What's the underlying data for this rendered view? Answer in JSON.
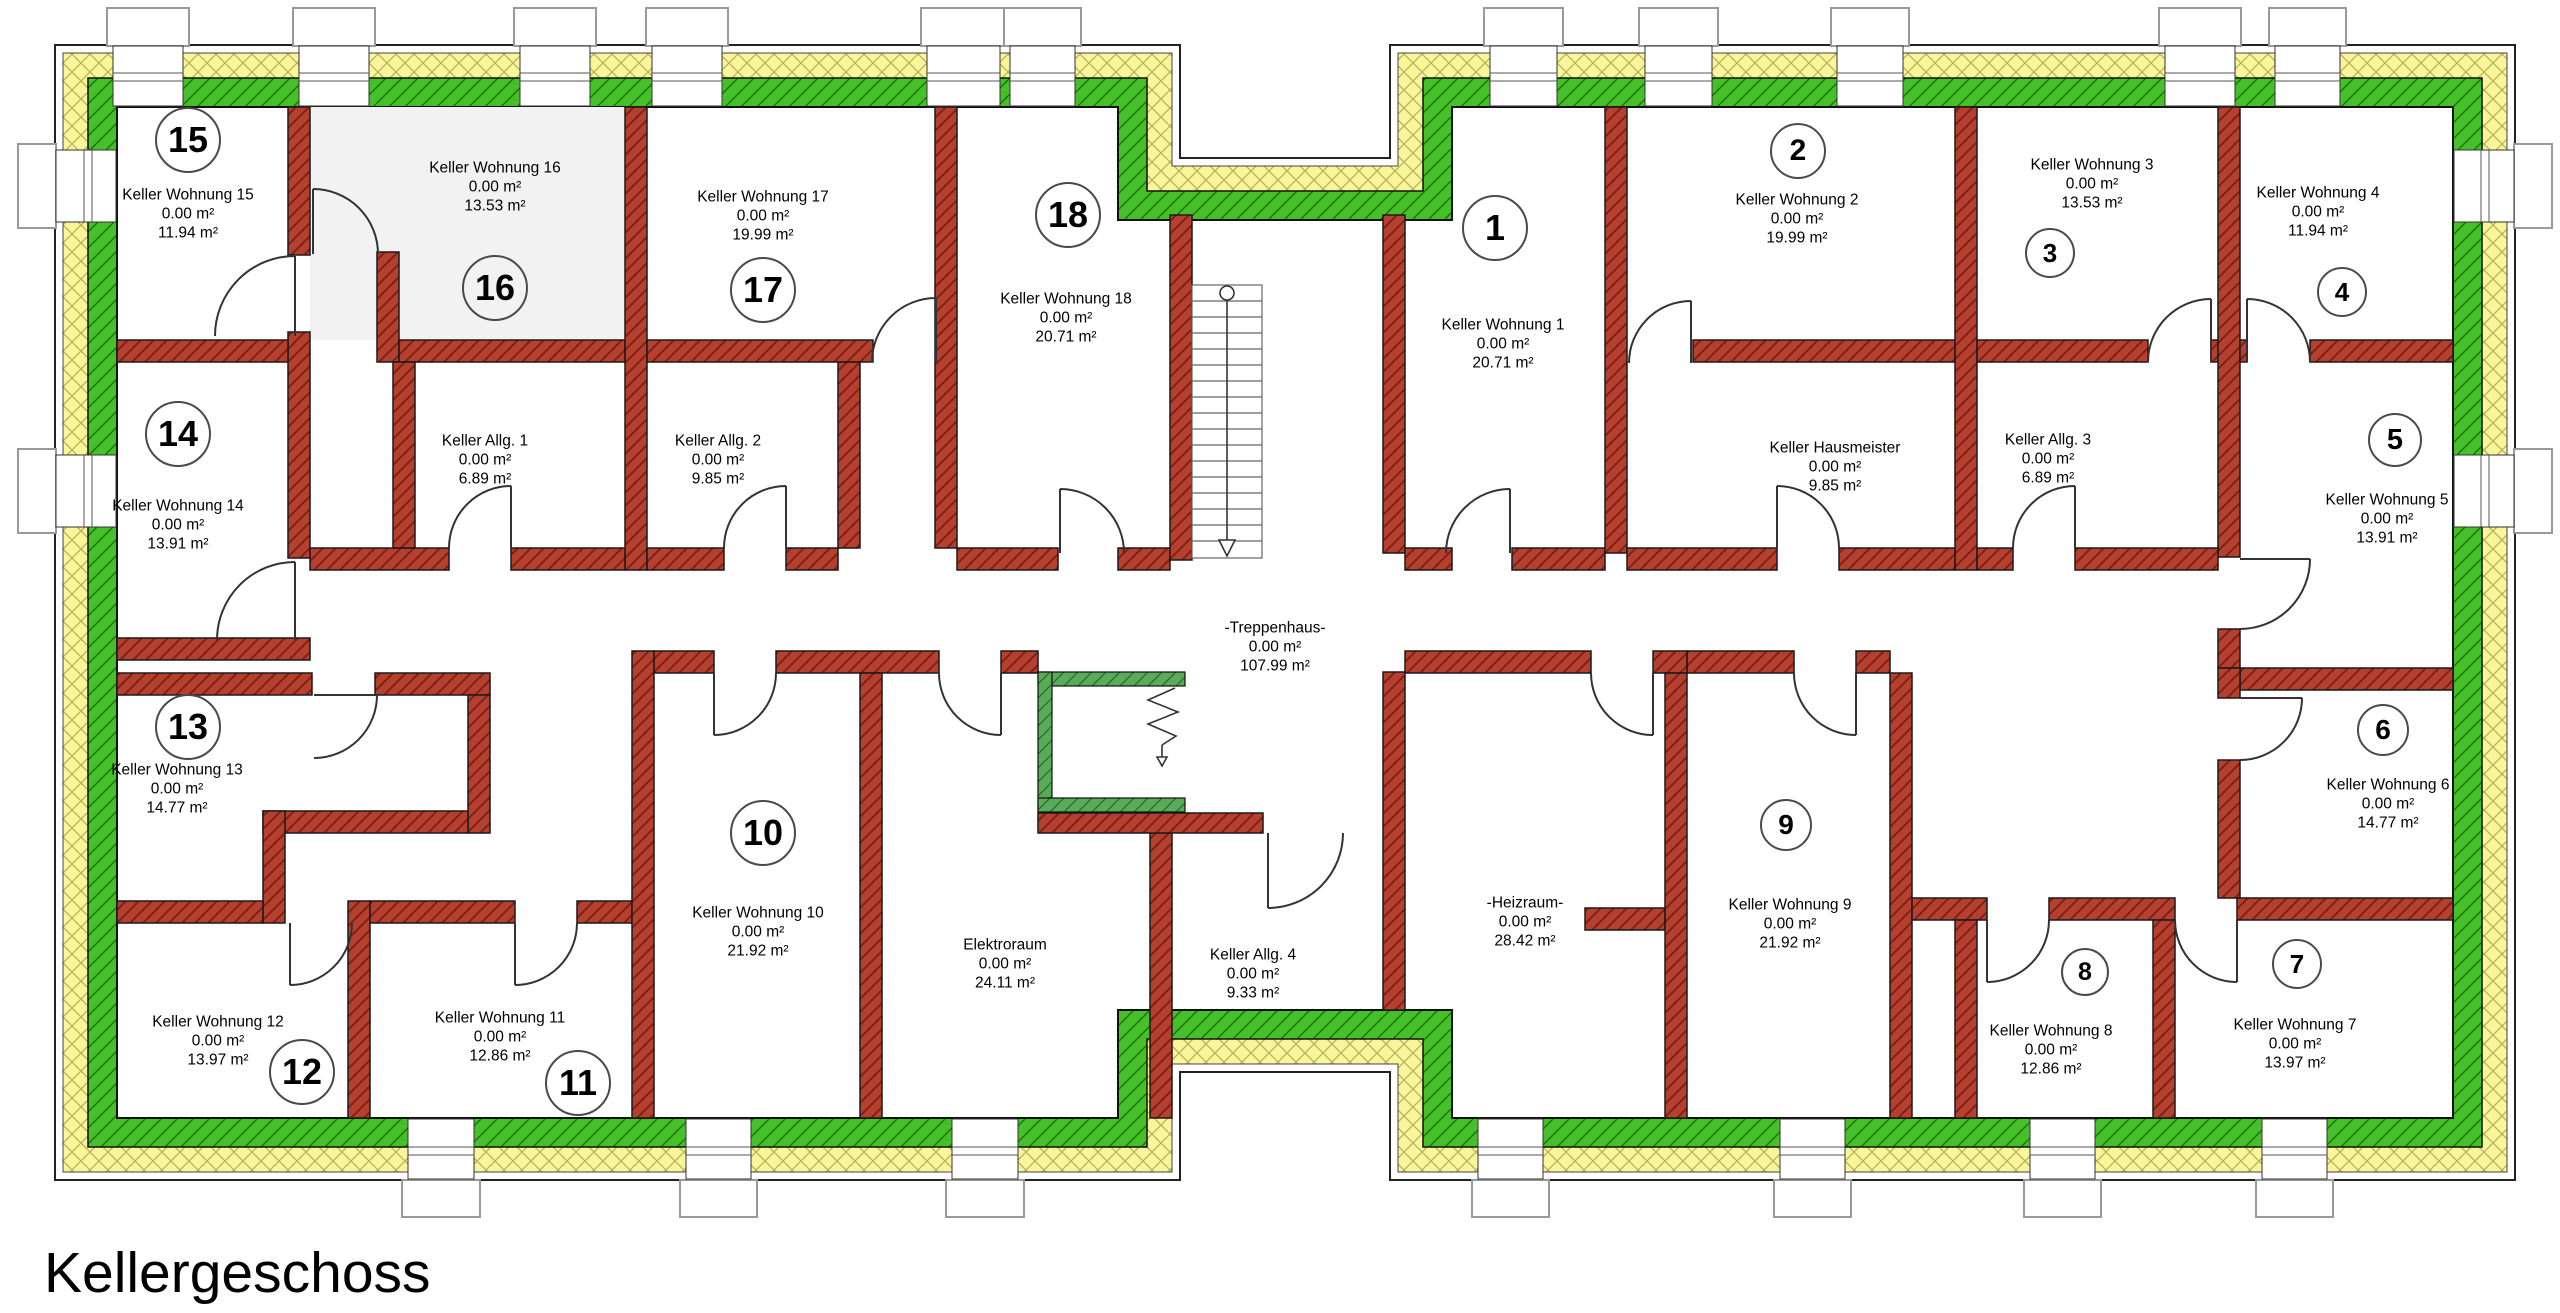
{
  "title": "Kellergeschoss",
  "colors": {
    "exterior_outer_hatch": "#f8f59b",
    "exterior_inner_hatch": "#46c028",
    "interior_wall_hatch": "#b6402f",
    "elevator_hatch": "#58ab57",
    "highlight_room_fill": "#f2f2f2"
  },
  "rooms": [
    {
      "num": "1",
      "name": "Keller Wohnung 1",
      "size": "0.00 m²",
      "area": "20.71 m²",
      "label": {
        "x": 1503,
        "y": 344
      },
      "badge": {
        "x": 1495,
        "y": 228,
        "r": 31
      }
    },
    {
      "num": "2",
      "name": "Keller Wohnung 2",
      "size": "0.00 m²",
      "area": "19.99 m²",
      "label": {
        "x": 1797,
        "y": 219
      },
      "badge": {
        "x": 1798,
        "y": 151,
        "r": 26
      }
    },
    {
      "num": "3",
      "name": "Keller Wohnung 3",
      "size": "0.00 m²",
      "area": "13.53 m²",
      "label": {
        "x": 2092,
        "y": 184
      },
      "badge": {
        "x": 2050,
        "y": 253,
        "r": 23
      }
    },
    {
      "num": "4",
      "name": "Keller Wohnung 4",
      "size": "0.00 m²",
      "area": "11.94 m²",
      "label": {
        "x": 2318,
        "y": 212
      },
      "badge": {
        "x": 2342,
        "y": 292,
        "r": 23
      }
    },
    {
      "num": "5",
      "name": "Keller Wohnung 5",
      "size": "0.00 m²",
      "area": "13.91 m²",
      "label": {
        "x": 2387,
        "y": 519
      },
      "badge": {
        "x": 2395,
        "y": 440,
        "r": 25
      }
    },
    {
      "num": "6",
      "name": "Keller Wohnung 6",
      "size": "0.00 m²",
      "area": "14.77 m²",
      "label": {
        "x": 2388,
        "y": 804
      },
      "badge": {
        "x": 2383,
        "y": 730,
        "r": 24
      }
    },
    {
      "num": "7",
      "name": "Keller Wohnung 7",
      "size": "0.00 m²",
      "area": "13.97 m²",
      "label": {
        "x": 2295,
        "y": 1044
      },
      "badge": {
        "x": 2297,
        "y": 964,
        "r": 23
      }
    },
    {
      "num": "8",
      "name": "Keller Wohnung 8",
      "size": "0.00 m²",
      "area": "12.86 m²",
      "label": {
        "x": 2051,
        "y": 1050
      },
      "badge": {
        "x": 2085,
        "y": 972,
        "r": 22
      }
    },
    {
      "num": "9",
      "name": "Keller Wohnung 9",
      "size": "0.00 m²",
      "area": "21.92 m²",
      "label": {
        "x": 1790,
        "y": 924
      },
      "badge": {
        "x": 1786,
        "y": 825,
        "r": 24
      }
    },
    {
      "num": "10",
      "name": "Keller Wohnung 10",
      "size": "0.00 m²",
      "area": "21.92 m²",
      "label": {
        "x": 758,
        "y": 932
      },
      "badge": {
        "x": 763,
        "y": 833,
        "r": 31
      }
    },
    {
      "num": "11",
      "name": "Keller Wohnung 11",
      "size": "0.00 m²",
      "area": "12.86 m²",
      "label": {
        "x": 500,
        "y": 1037
      },
      "badge": {
        "x": 578,
        "y": 1083,
        "r": 31
      }
    },
    {
      "num": "12",
      "name": "Keller Wohnung 12",
      "size": "0.00 m²",
      "area": "13.97 m²",
      "label": {
        "x": 218,
        "y": 1041
      },
      "badge": {
        "x": 302,
        "y": 1072,
        "r": 31
      }
    },
    {
      "num": "13",
      "name": "Keller Wohnung 13",
      "size": "0.00 m²",
      "area": "14.77 m²",
      "label": {
        "x": 177,
        "y": 789
      },
      "badge": {
        "x": 188,
        "y": 727,
        "r": 31
      }
    },
    {
      "num": "14",
      "name": "Keller Wohnung 14",
      "size": "0.00 m²",
      "area": "13.91 m²",
      "label": {
        "x": 178,
        "y": 525
      },
      "badge": {
        "x": 178,
        "y": 434,
        "r": 31
      }
    },
    {
      "num": "15",
      "name": "Keller Wohnung 15",
      "size": "0.00 m²",
      "area": "11.94 m²",
      "label": {
        "x": 188,
        "y": 214
      },
      "badge": {
        "x": 188,
        "y": 140,
        "r": 31
      }
    },
    {
      "num": "16",
      "name": "Keller Wohnung 16",
      "size": "0.00 m²",
      "area": "13.53 m²",
      "label": {
        "x": 495,
        "y": 187
      },
      "badge": {
        "x": 495,
        "y": 288,
        "r": 31
      }
    },
    {
      "num": "17",
      "name": "Keller Wohnung 17",
      "size": "0.00 m²",
      "area": "19.99 m²",
      "label": {
        "x": 763,
        "y": 216
      },
      "badge": {
        "x": 763,
        "y": 290,
        "r": 31
      }
    },
    {
      "num": "18",
      "name": "Keller Wohnung 18",
      "size": "0.00 m²",
      "area": "20.71 m²",
      "label": {
        "x": 1066,
        "y": 318
      },
      "badge": {
        "x": 1068,
        "y": 215,
        "r": 31
      }
    }
  ],
  "spaces": [
    {
      "name": "Keller Allg. 1",
      "size": "0.00 m²",
      "area": "6.89 m²",
      "label": {
        "x": 485,
        "y": 460
      }
    },
    {
      "name": "Keller Allg. 2",
      "size": "0.00 m²",
      "area": "9.85 m²",
      "label": {
        "x": 718,
        "y": 460
      }
    },
    {
      "name": "Keller Allg. 3",
      "size": "0.00 m²",
      "area": "6.89 m²",
      "label": {
        "x": 2048,
        "y": 459
      }
    },
    {
      "name": "Keller Allg. 4",
      "size": "0.00 m²",
      "area": "9.33 m²",
      "label": {
        "x": 1253,
        "y": 974
      }
    },
    {
      "name": "Keller Hausmeister",
      "size": "0.00 m²",
      "area": "9.85 m²",
      "label": {
        "x": 1835,
        "y": 467
      }
    },
    {
      "name": "-Treppenhaus-",
      "size": "0.00 m²",
      "area": "107.99 m²",
      "label": {
        "x": 1275,
        "y": 647
      }
    },
    {
      "name": "Elektroraum",
      "size": "0.00 m²",
      "area": "24.11 m²",
      "label": {
        "x": 1005,
        "y": 964
      }
    },
    {
      "name": "-Heizraum-",
      "size": "0.00 m²",
      "area": "28.42 m²",
      "label": {
        "x": 1525,
        "y": 922
      }
    }
  ]
}
